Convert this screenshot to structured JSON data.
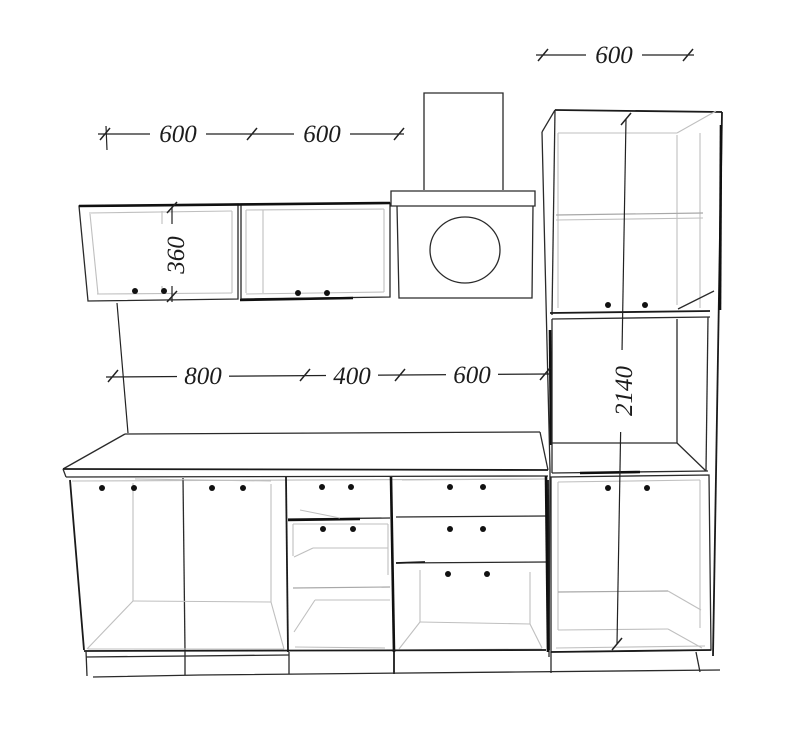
{
  "drawing": {
    "dimensions": {
      "wall_cabinet_left_width": "600",
      "wall_cabinet_right_width": "600",
      "tall_cabinet_width": "600",
      "wall_cabinet_height": "360",
      "base_section_1_width": "800",
      "base_section_2_width": "400",
      "base_section_3_width": "600",
      "tall_cabinet_height": "2140"
    },
    "colors": {
      "line": "#2a2a2a",
      "bold_line": "#101010",
      "interior_line": "#bfbfbf",
      "text": "#1c1c1c",
      "background": "#ffffff"
    }
  }
}
